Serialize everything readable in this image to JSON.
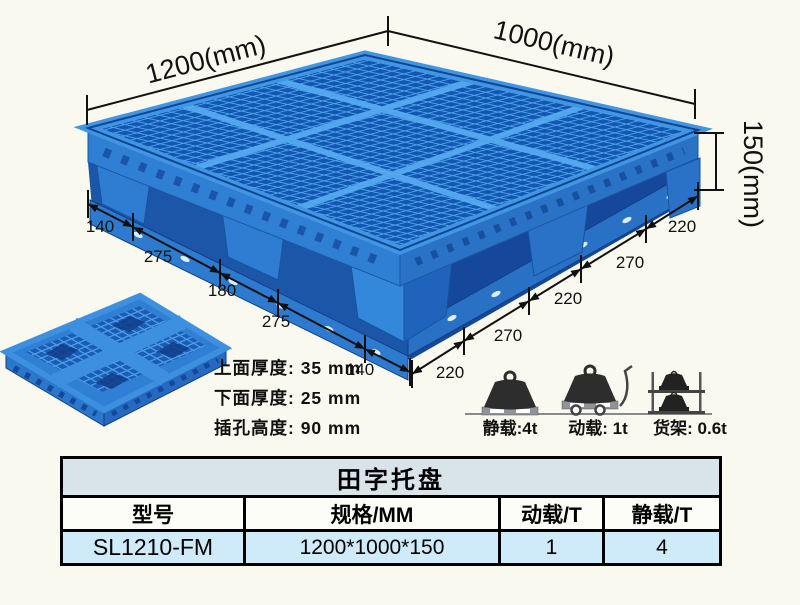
{
  "colors": {
    "background": "#faf9ef",
    "pallet_blue": "#2f80d4",
    "pallet_dark": "#1457b2",
    "pallet_light": "#4aa0e8",
    "table_title_bg": "#d9e3ea",
    "table_data_bg": "#cfeaf8",
    "line_color": "#111111"
  },
  "illustration": {
    "dims": {
      "length": "1200(mm)",
      "width": "1000(mm)",
      "height": "150(mm)"
    },
    "left_chain": [
      "140",
      "275",
      "180",
      "275",
      "140"
    ],
    "right_chain": [
      "220",
      "270",
      "220",
      "270",
      "220"
    ],
    "notes": [
      "上面厚度: 35 mm",
      "下面厚度: 25 mm",
      "插孔高度: 90 mm"
    ]
  },
  "loads": {
    "items": [
      {
        "icon": "static-load-icon",
        "label": "静载:4t"
      },
      {
        "icon": "dynamic-load-icon",
        "label": "动载: 1t"
      },
      {
        "icon": "rack-load-icon",
        "label": "货架: 0.6t"
      }
    ]
  },
  "table": {
    "title": "田字托盘",
    "headers": [
      "型号",
      "规格/MM",
      "动载/T",
      "静载/T"
    ],
    "rows": [
      [
        "SL1210-FM",
        "1200*1000*150",
        "1",
        "4"
      ]
    ]
  }
}
